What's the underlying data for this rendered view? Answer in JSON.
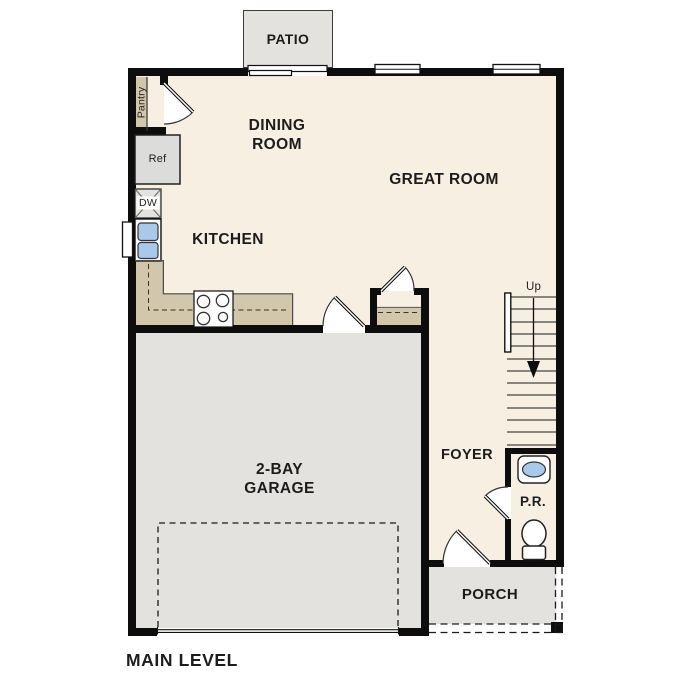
{
  "title": "MAIN LEVEL",
  "rooms": {
    "patio": "PATIO",
    "dining_room": "DINING ROOM",
    "great_room": "GREAT ROOM",
    "kitchen": "KITCHEN",
    "garage": "2-BAY GARAGE",
    "foyer": "FOYER",
    "powder_room": "P.R.",
    "porch": "PORCH"
  },
  "fixtures": {
    "pantry": "Pantry",
    "refrigerator": "Ref",
    "dishwasher": "DW",
    "stairs_up": "Up"
  },
  "colors": {
    "floor": "#f6efe2",
    "counter": "#d2c6ab",
    "concrete": "#e3e2df",
    "fixture_blue": "#a9c9ea",
    "wall": "#0d0d0d"
  }
}
